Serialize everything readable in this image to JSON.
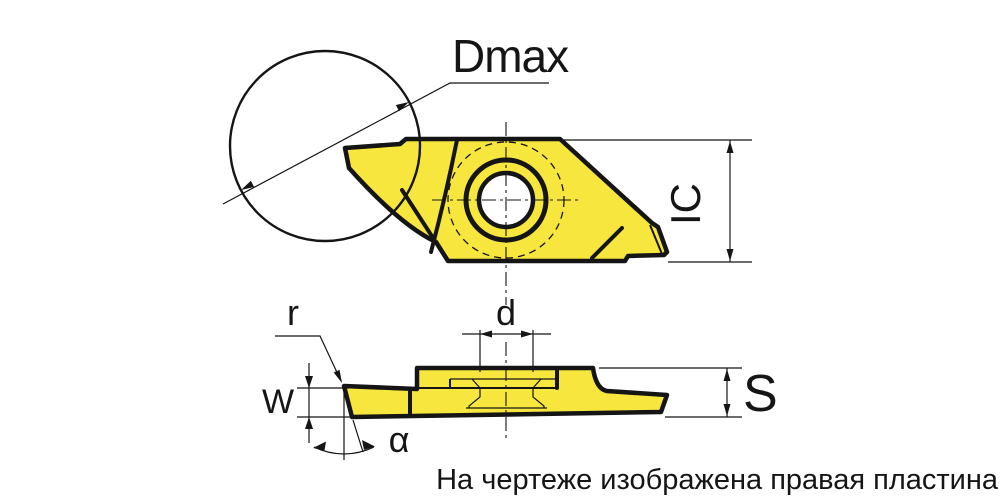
{
  "labels": {
    "dmax": "Dmax",
    "ic": "IC",
    "d": "d",
    "s": "S",
    "w": "W",
    "r": "r",
    "alpha": "α"
  },
  "caption": {
    "text": "На чертеже изображена правая пластина"
  },
  "colors": {
    "insert_fill": "#F7E63D",
    "line": "#151515",
    "background": "#FFFFFF"
  }
}
